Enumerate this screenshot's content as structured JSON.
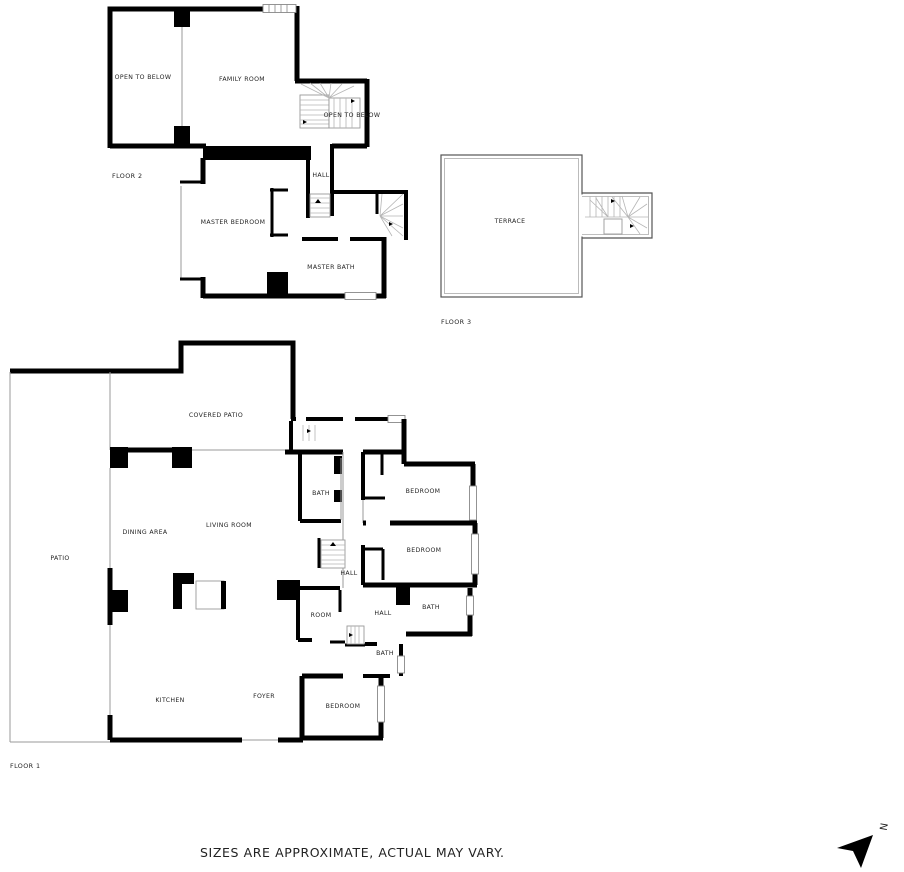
{
  "page": {
    "background_color": "#ffffff",
    "wall_color": "#000000",
    "thin_line_color": "#9a9a9a",
    "text_color": "#1f1f1f"
  },
  "floor2": {
    "label": "FLOOR 2",
    "rooms": {
      "open_to_below_left": "OPEN TO BELOW",
      "family_room": "FAMILY ROOM",
      "open_to_below_stairs": "OPEN TO BELOW",
      "hall": "HALL",
      "master_bedroom": "MASTER BEDROOM",
      "master_bath": "MASTER BATH"
    }
  },
  "floor3": {
    "label": "FLOOR 3",
    "rooms": {
      "terrace": "TERRACE"
    }
  },
  "floor1": {
    "label": "FLOOR 1",
    "rooms": {
      "covered_patio": "COVERED PATIO",
      "patio": "PATIO",
      "dining_area": "DINING AREA",
      "living_room": "LIVING ROOM",
      "kitchen": "KITCHEN",
      "foyer": "FOYER",
      "bath_top": "BATH",
      "bedroom_top": "BEDROOM",
      "bedroom_middle": "BEDROOM",
      "hall_center": "HALL",
      "room": "ROOM",
      "hall_south": "HALL",
      "bath_east": "BATH",
      "bath_south": "BATH",
      "bedroom_south": "BEDROOM"
    }
  },
  "footer": {
    "disclaimer": "SIZES ARE APPROXIMATE, ACTUAL MAY VARY."
  },
  "compass": {
    "north": "N"
  }
}
